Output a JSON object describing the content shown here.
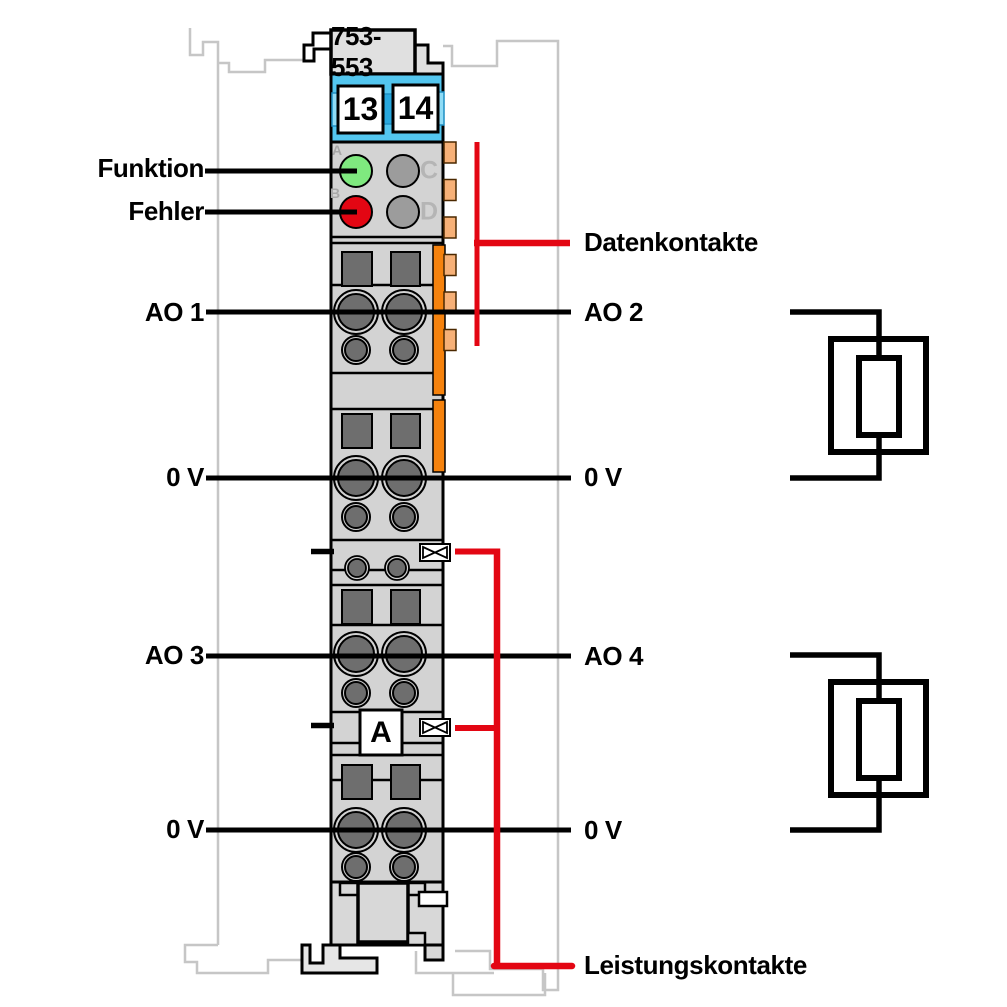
{
  "module": {
    "part_number": "753-553",
    "terminal_numbers": [
      "13",
      "14"
    ],
    "marker_label": "A",
    "led_letters": [
      "A",
      "B",
      "C",
      "D"
    ]
  },
  "labels": {
    "left": [
      {
        "id": "funktion",
        "label": "Funktion"
      },
      {
        "id": "fehler",
        "label": "Fehler"
      },
      {
        "id": "ao1",
        "label": "AO 1"
      },
      {
        "id": "ov1",
        "label": "0 V"
      },
      {
        "id": "ao3",
        "label": "AO 3"
      },
      {
        "id": "ov2",
        "label": "0 V"
      }
    ],
    "right": [
      {
        "id": "datenkontakte",
        "label": "Datenkontakte"
      },
      {
        "id": "ao2",
        "label": "AO 2"
      },
      {
        "id": "ov3",
        "label": "0 V"
      },
      {
        "id": "ao4",
        "label": "AO 4"
      },
      {
        "id": "ov4",
        "label": "0 V"
      },
      {
        "id": "leistungskontakte",
        "label": "Leistungskontakte"
      }
    ]
  },
  "colors": {
    "accent_red": "#E30613",
    "led_green": "#7FE97F",
    "led_red": "#E30613",
    "led_off": "#9C9C9C",
    "terminal_blue": "#53C6EF",
    "latch_orange": "#F5820D",
    "data_contact_orange": "#F6B077",
    "module_gray": "#D3D3D3",
    "neighbor_outline_gray": "#C6C6C6",
    "line_black": "#000000"
  }
}
